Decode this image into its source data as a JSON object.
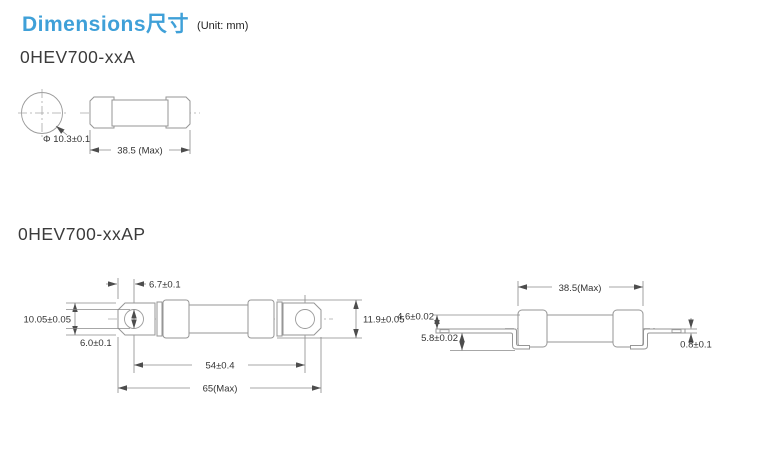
{
  "header": {
    "title": "Dimensions尺寸",
    "unit": "(Unit: mm)"
  },
  "sections": {
    "a": {
      "model": "0HEV700-xxA",
      "dims": {
        "diameter": "Φ 10.3±0.1",
        "length": "38.5 (Max)"
      }
    },
    "ap": {
      "model": "0HEV700-xxAP",
      "front": {
        "hole_offset": "6.7±0.1",
        "tab_height": "10.05±0.05",
        "hole_diameter": "6.0±0.1",
        "hole_pitch": "54±0.4",
        "overall_length": "65(Max)",
        "body_height": "11.9±0.05"
      },
      "side": {
        "body_length": "38.5(Max)",
        "top_offset": "4.6±0.02",
        "bottom_offset": "5.8±0.02",
        "terminal_thickness": "0.8±0.1"
      }
    }
  },
  "colors": {
    "accent_blue": "#3fa0d8",
    "line_gray": "#969696",
    "text_dark": "#333333"
  }
}
